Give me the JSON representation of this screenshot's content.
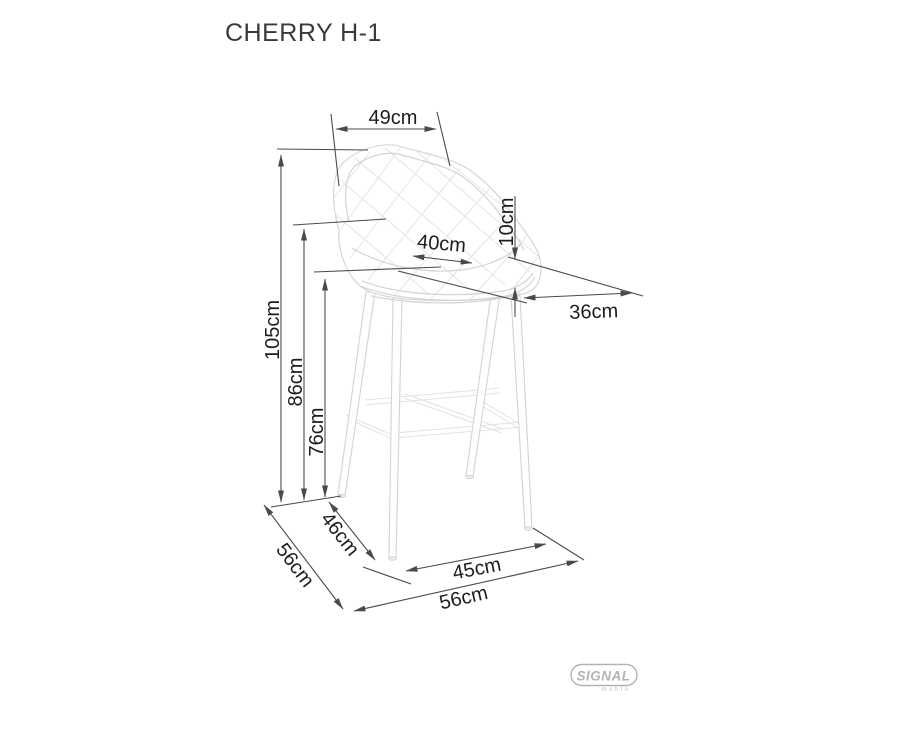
{
  "title": "CHERRY H-1",
  "dimensions": {
    "back_width": "49cm",
    "cushion_thickness": "10cm",
    "seat_width": "40cm",
    "seat_depth": "36cm",
    "total_height": "105cm",
    "back_lower_height": "86cm",
    "seat_height": "76cm",
    "feet_depth_inner": "46cm",
    "total_depth": "56cm",
    "feet_width_front": "45cm",
    "total_width": "56cm"
  },
  "logo": {
    "brand": "SIGNAL",
    "subtitle": "meble"
  },
  "colors": {
    "dimension_lines": "#4a4a4a",
    "label_text": "#1d1d1d",
    "chair_outline": "#d3d3d3",
    "logo_gray": "#b3b3b3",
    "background": "#ffffff"
  }
}
